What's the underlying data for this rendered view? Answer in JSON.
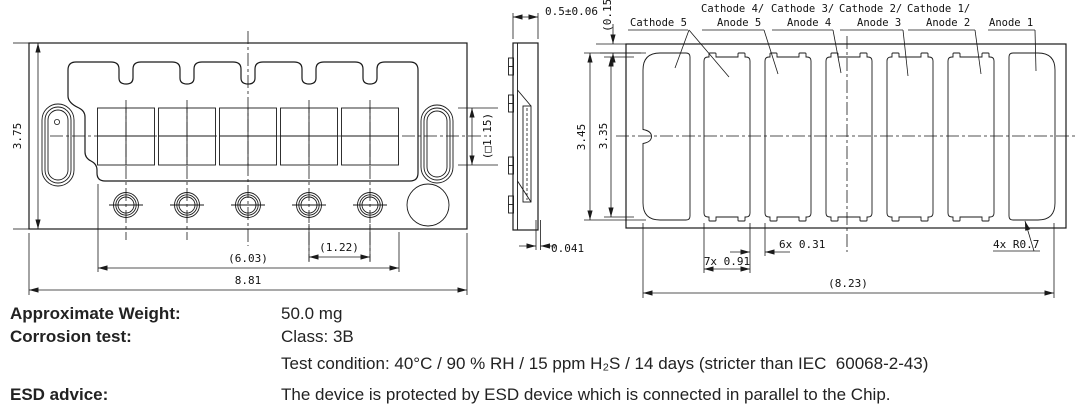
{
  "views": {
    "front": {
      "height": "3.75",
      "pitch": "(1.22)",
      "span": "(6.03)",
      "width": "8.81"
    },
    "side": {
      "thickness": "0.5±0.06",
      "window": "(□1.15)",
      "standoff": "0.041",
      "recess": "(0.15)"
    },
    "back": {
      "pad_height_outer": "3.45",
      "pad_height": "3.35",
      "pad_width": "7x 0.91",
      "pad_gap": "6x 0.31",
      "corner_radius": "4x R0.7",
      "pad_span": "(8.23)",
      "labels": {
        "cathode5": "Cathode 5",
        "c4": "Cathode 4/",
        "a5": "Anode 5",
        "c3": "Cathode 3/",
        "a4": "Anode 4",
        "c2": "Cathode 2/",
        "a3": "Anode 3",
        "c1": "Cathode 1/",
        "a2": "Anode 2",
        "a1": "Anode 1"
      }
    }
  },
  "specs": {
    "rows": [
      {
        "label": "Approximate Weight:",
        "value": "50.0 mg"
      },
      {
        "label": "Corrosion test:",
        "value": "Class: 3B"
      },
      {
        "label": "",
        "value": "Test condition: 40°C / 90 % RH / 15 ppm H₂S / 14 days (stricter than IEC  60068-2-43)"
      },
      {
        "label": "ESD advice:",
        "value": "The device is protected by ESD device which is connected in parallel to the Chip."
      }
    ]
  }
}
